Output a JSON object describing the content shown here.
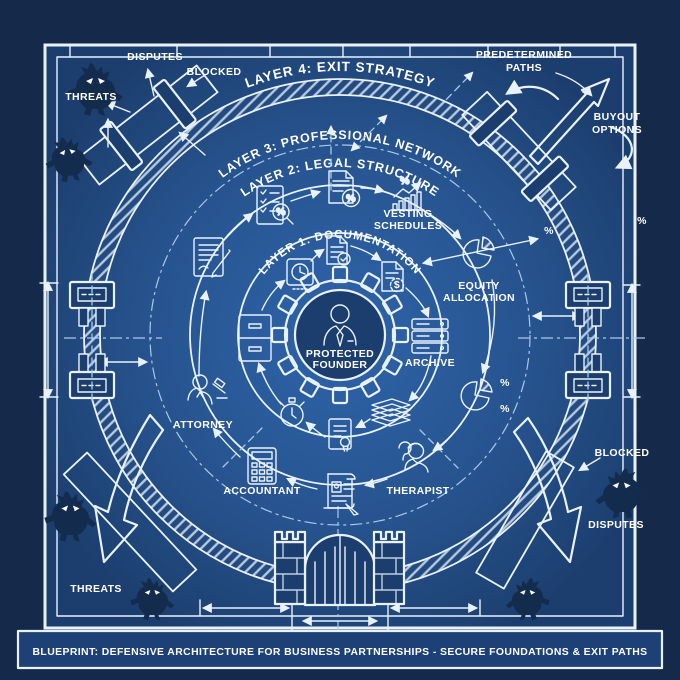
{
  "title": "BLUEPRINT: DEFENSIVE ARCHITECTURE FOR BUSINESS PARTNERSHIPS - SECURE FOUNDATIONS & EXIT PATHS",
  "layers": {
    "layer4": "LAYER 4: EXIT STRATEGY",
    "layer3": "LAYER 3: PROFESSIONAL NETWORK",
    "layer2": "LAYER 2: LEGAL STRUCTURE",
    "layer1": "LAYER 1: DOCUMENTATION"
  },
  "center": {
    "line1": "PROTECTED",
    "line2": "FOUNDER"
  },
  "inner_icons": {
    "archive": "ARCHIVE"
  },
  "professionals": {
    "attorney": "ATTORNEY",
    "accountant": "ACCOUNTANT",
    "therapist": "THERAPIST"
  },
  "annotations": {
    "vesting1": "VESTING",
    "vesting2": "SCHEDULES",
    "equity1": "EQUITY",
    "equity2": "ALLOCATION",
    "predetermined1": "PREDETERMINED",
    "predetermined2": "PATHS",
    "buyout1": "BUYOUT",
    "buyout2": "OPTIONS",
    "disputes": "DISPUTES",
    "blocked": "BLOCKED",
    "threats": "THREATS",
    "percent": "%",
    "dollar": "$"
  },
  "colors": {
    "page_bg": "#15294b",
    "field_light": "#2e64aa",
    "field_mid": "#27548f",
    "field_dark": "#1c3e6e",
    "line": "#e9f2fb",
    "dashed": "#a9c9ee",
    "monster": "#132c4e",
    "text": "#ffffff",
    "titlebar_bg": "#1d4176"
  }
}
